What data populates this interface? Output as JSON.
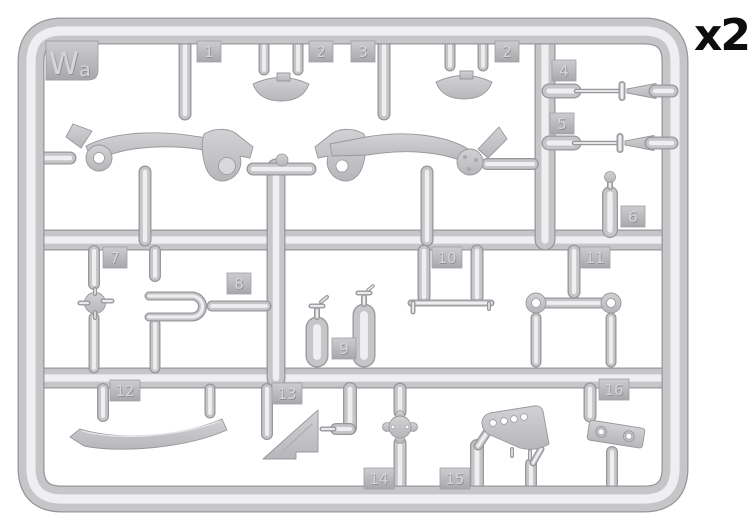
{
  "sprue": {
    "code": "Wa",
    "quantity": "x2",
    "part_tabs": [
      {
        "number": "1",
        "x": 197,
        "y": 41
      },
      {
        "number": "2",
        "x": 309,
        "y": 41
      },
      {
        "number": "3",
        "x": 351,
        "y": 41
      },
      {
        "number": "2",
        "x": 495,
        "y": 41
      },
      {
        "number": "4",
        "x": 552,
        "y": 60
      },
      {
        "number": "5",
        "x": 550,
        "y": 113
      },
      {
        "number": "6",
        "x": 621,
        "y": 206
      },
      {
        "number": "7",
        "x": 103,
        "y": 247
      },
      {
        "number": "8",
        "x": 227,
        "y": 273
      },
      {
        "number": "9",
        "x": 332,
        "y": 338
      },
      {
        "number": "10",
        "x": 432,
        "y": 247
      },
      {
        "number": "11",
        "x": 580,
        "y": 247
      },
      {
        "number": "12",
        "x": 110,
        "y": 380
      },
      {
        "number": "13",
        "x": 272,
        "y": 383
      },
      {
        "number": "14",
        "x": 364,
        "y": 468
      },
      {
        "number": "15",
        "x": 440,
        "y": 468
      },
      {
        "number": "16",
        "x": 599,
        "y": 379
      }
    ],
    "colors": {
      "background": "#ffffff",
      "plastic_base": "#c6c6c9",
      "plastic_highlight": "#efeff1",
      "plastic_edge": "#98989c",
      "flat_light": "#d2d2d5",
      "flat_dark": "#b7b7bb",
      "tab_light": "#cdcdd0",
      "tab_dark": "#a8a8ac",
      "emboss_shadow": "#8f8f93",
      "emboss_face": "#d6d6d9",
      "quantity_text": "#0d0d0d"
    }
  }
}
